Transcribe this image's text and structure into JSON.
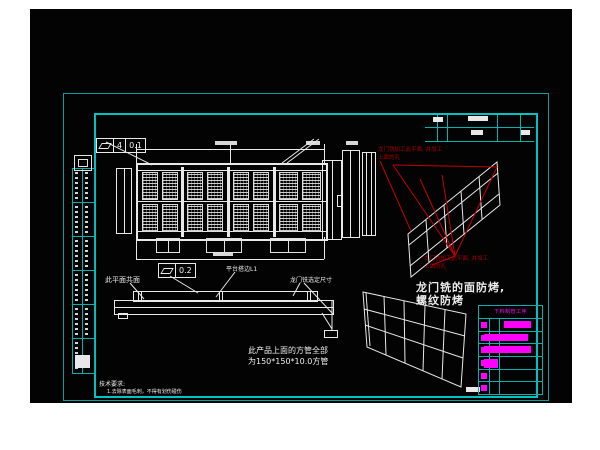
{
  "colors": {
    "page_background": "#ffffff",
    "canvas_background": "#030303",
    "frame_cyan": "#00c2c2",
    "drawing_white": "#e8e8e8",
    "annotation_red": "#a80000",
    "table_magenta": "#ff00ff"
  },
  "gdt": {
    "frame1_size": "4",
    "frame1_tolerance": "0.1",
    "frame2_tolerance": "0.2"
  },
  "notes": {
    "coplanar": "此平面共面",
    "platform_l1": "平台搭边L1",
    "gantry_dim": "龙门铣选定尺寸",
    "tube_line1": "此产品上面的方管全部",
    "tube_line2": "为150*150*10.0方管",
    "tech_title": "技术要求:",
    "tech_line": "1.去除表面毛刺，不得有划伤碰伤",
    "red_note_line1": "龙门铣加工此平面, 并加工",
    "red_note_line2": "上面的孔",
    "bake_note_line1": "龙门铣的面防烤,",
    "bake_note_line2": "螺纹防烤"
  },
  "process_table": {
    "header": "下料制管工序",
    "rows": [
      {
        "marker": true,
        "bar_x": 25,
        "bar_w": 27
      },
      {
        "marker": true,
        "bar_x": 5,
        "bar_w": 44
      },
      {
        "marker": true,
        "bar_x": 5,
        "bar_w": 47
      },
      {
        "marker": true,
        "bar_x": 5,
        "bar_w": 14,
        "bar_h": 9
      },
      {
        "marker": true
      },
      {
        "marker": true
      }
    ]
  }
}
